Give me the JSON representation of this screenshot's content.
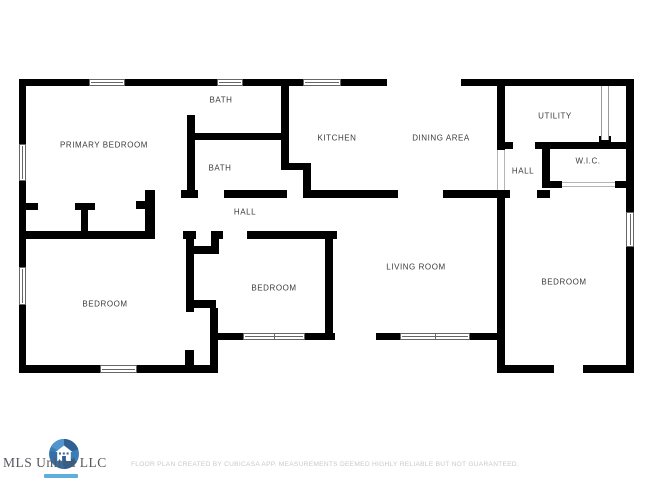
{
  "watermark": {
    "name": "MLS United LLC",
    "logo": "house-shutter-logo"
  },
  "footer": {
    "disclaimer": "FLOOR PLAN CREATED BY CUBICASA APP. MEASUREMENTS DEEMED HIGHLY RELIABLE BUT NOT GUARANTEED."
  },
  "floorplan": {
    "colors": {
      "wall-color": "#000000",
      "label-color": "#3a3a3a",
      "window-border": "#666666",
      "passage-color": "#b5b5b5",
      "footer-color": "#c9c9c9",
      "logo-blue": "#3379b7",
      "logo-blue-dark": "#27598f",
      "tagline-blue": "#3fa0d6"
    },
    "rooms": [
      {
        "label": "PRIMARY BEDROOM",
        "x": 104,
        "y": 145
      },
      {
        "label": "BATH",
        "x": 221,
        "y": 100
      },
      {
        "label": "BATH",
        "x": 220,
        "y": 168
      },
      {
        "label": "KITCHEN",
        "x": 337,
        "y": 138
      },
      {
        "label": "DINING AREA",
        "x": 441,
        "y": 138
      },
      {
        "label": "UTILITY",
        "x": 555,
        "y": 116
      },
      {
        "label": "HALL",
        "x": 523,
        "y": 171
      },
      {
        "label": "W.I.C.",
        "x": 588,
        "y": 161
      },
      {
        "label": "HALL",
        "x": 245,
        "y": 212
      },
      {
        "label": "BEDROOM",
        "x": 105,
        "y": 304
      },
      {
        "label": "BEDROOM",
        "x": 274,
        "y": 288
      },
      {
        "label": "LIVING ROOM",
        "x": 416,
        "y": 267
      },
      {
        "label": "BEDROOM",
        "x": 564,
        "y": 282
      }
    ],
    "walls": [
      [
        19,
        79,
        70,
        7
      ],
      [
        125,
        79,
        92,
        7
      ],
      [
        243,
        79,
        60,
        7
      ],
      [
        341,
        79,
        46,
        7
      ],
      [
        461,
        79,
        173,
        7
      ],
      [
        19,
        79,
        7,
        65
      ],
      [
        19,
        181,
        7,
        86
      ],
      [
        19,
        305,
        7,
        68
      ],
      [
        626,
        79,
        8,
        133
      ],
      [
        626,
        247,
        8,
        126
      ],
      [
        19,
        365,
        81,
        8
      ],
      [
        137,
        365,
        75,
        8
      ],
      [
        210,
        308,
        8,
        65
      ],
      [
        185,
        350,
        9,
        15
      ],
      [
        210,
        333,
        33,
        7
      ],
      [
        305,
        333,
        30,
        7
      ],
      [
        325,
        231,
        8,
        107
      ],
      [
        376,
        333,
        24,
        7
      ],
      [
        470,
        333,
        34,
        7
      ],
      [
        497,
        365,
        57,
        8
      ],
      [
        583,
        365,
        51,
        8
      ],
      [
        497,
        198,
        8,
        175
      ],
      [
        187,
        115,
        8,
        83
      ],
      [
        191,
        133,
        91,
        7
      ],
      [
        281,
        85,
        8,
        85
      ],
      [
        281,
        163,
        29,
        7
      ],
      [
        303,
        163,
        8,
        35
      ],
      [
        497,
        84,
        8,
        66
      ],
      [
        497,
        142,
        16,
        7
      ],
      [
        535,
        142,
        99,
        7
      ],
      [
        542,
        142,
        8,
        46
      ],
      [
        548,
        181,
        14,
        7
      ],
      [
        615,
        181,
        11,
        7
      ],
      [
        599,
        136,
        12,
        6
      ],
      [
        145,
        190,
        10,
        49
      ],
      [
        136,
        201,
        9,
        8
      ],
      [
        181,
        190,
        17,
        8
      ],
      [
        224,
        190,
        63,
        8
      ],
      [
        310,
        190,
        88,
        8
      ],
      [
        443,
        190,
        67,
        8
      ],
      [
        537,
        190,
        13,
        8
      ],
      [
        19,
        231,
        134,
        8
      ],
      [
        183,
        231,
        13,
        8
      ],
      [
        211,
        231,
        12,
        8
      ],
      [
        247,
        231,
        90,
        8
      ],
      [
        186,
        231,
        8,
        81
      ],
      [
        186,
        246,
        33,
        8
      ],
      [
        211,
        231,
        8,
        23
      ],
      [
        186,
        300,
        30,
        8
      ],
      [
        26,
        203,
        12,
        7
      ],
      [
        75,
        203,
        20,
        7
      ],
      [
        81,
        210,
        7,
        23
      ]
    ],
    "windows": [
      {
        "x": 89,
        "y": 79,
        "w": 36,
        "h": 7,
        "panes": 1
      },
      {
        "x": 217,
        "y": 79,
        "w": 26,
        "h": 7,
        "panes": 1
      },
      {
        "x": 303,
        "y": 79,
        "w": 38,
        "h": 7,
        "panes": 1
      },
      {
        "x": 19,
        "y": 144,
        "w": 7,
        "h": 37,
        "panes": 1
      },
      {
        "x": 19,
        "y": 267,
        "w": 7,
        "h": 38,
        "panes": 1
      },
      {
        "x": 626,
        "y": 212,
        "w": 8,
        "h": 35,
        "panes": 1
      },
      {
        "x": 100,
        "y": 365,
        "w": 37,
        "h": 8,
        "panes": 1
      },
      {
        "x": 243,
        "y": 333,
        "w": 62,
        "h": 7,
        "panes": 2
      },
      {
        "x": 400,
        "y": 333,
        "w": 70,
        "h": 7,
        "panes": 2
      }
    ],
    "passages": [
      {
        "type": "v",
        "x": 497,
        "y": 150,
        "w": 8,
        "h": 40
      },
      {
        "type": "pocket",
        "x": 601,
        "y": 86,
        "w": 8,
        "h": 54
      },
      {
        "type": "h",
        "x": 562,
        "y": 182,
        "w": 53,
        "h": 5
      }
    ]
  }
}
